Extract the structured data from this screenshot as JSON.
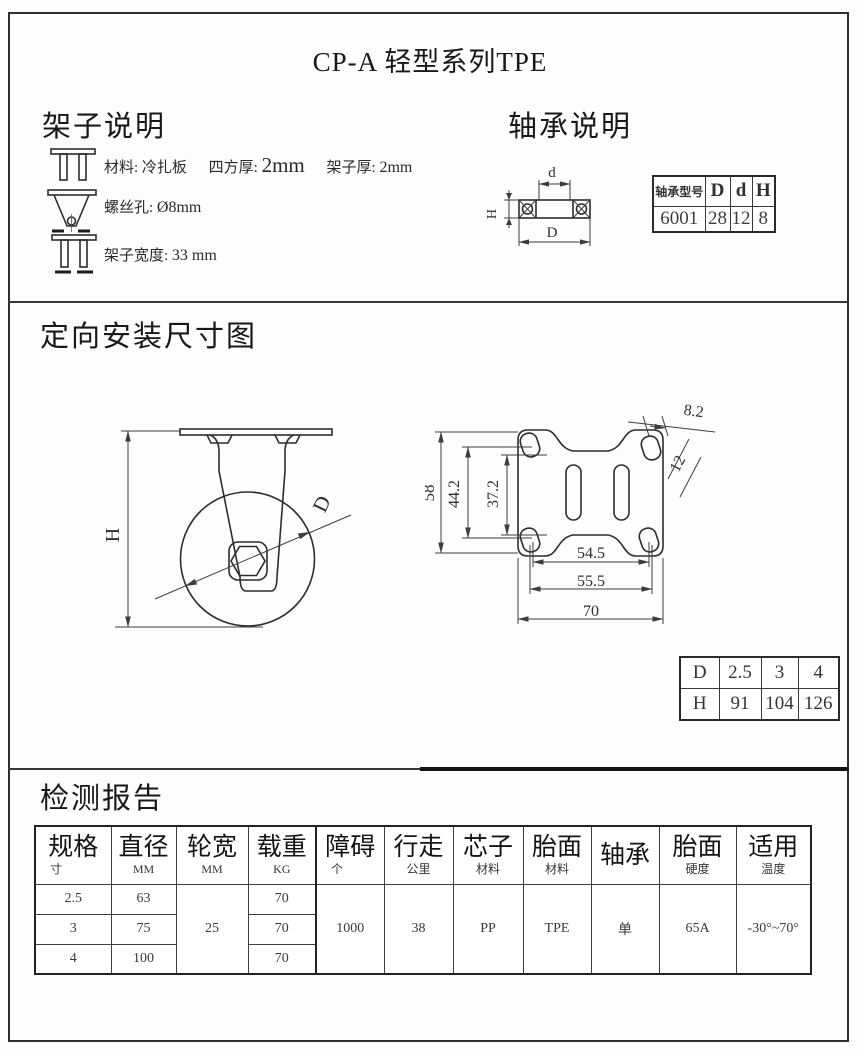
{
  "page_title": "CP-A  轻型系列TPE",
  "frame_section": {
    "heading": "架子说明",
    "material_line": {
      "label1": "材料: 冷扎板",
      "label2": "四方厚:",
      "value2": "2mm",
      "label3": "架子厚:",
      "value3": "2mm"
    },
    "screw_line": {
      "label": "螺丝孔:",
      "value": "Ø8mm"
    },
    "width_line": {
      "label": "架子宽度:",
      "value": "33 mm"
    }
  },
  "bearing_section": {
    "heading": "轴承说明",
    "diagram": {
      "dim_d": "d",
      "dim_D": "D",
      "dim_H": "H"
    },
    "table": {
      "col_model": "轴承型号",
      "col_D": "D",
      "col_d": "d",
      "col_H": "H",
      "model": "6001",
      "D": "28",
      "d": "12",
      "H": "8"
    }
  },
  "mounting_section": {
    "heading": "定向安装尺寸图",
    "side_view": {
      "dim_H": "H",
      "dim_D": "D"
    },
    "top_view": {
      "plate_height": "58",
      "hole_span_v": "44.2",
      "slot_span_v": "37.2",
      "hole_span_h": "54.5",
      "hole_span_h2": "55.5",
      "plate_width": "70",
      "hole_width": "8.2",
      "hole_length": "12"
    },
    "dh_table": {
      "row_d": [
        "D",
        "2.5",
        "3",
        "4"
      ],
      "row_h": [
        "H",
        "91",
        "104",
        "126"
      ]
    }
  },
  "report_section": {
    "heading": "检测报告",
    "table": {
      "headers": [
        {
          "main": "规格",
          "sub": "寸"
        },
        {
          "main": "直径",
          "sub": "MM"
        },
        {
          "main": "轮宽",
          "sub": "MM"
        },
        {
          "main": "载重",
          "sub": "KG"
        },
        {
          "main": "障碍",
          "sub": "个"
        },
        {
          "main": "行走",
          "sub": "公里"
        },
        {
          "main": "芯子",
          "sub": "材料"
        },
        {
          "main": "胎面",
          "sub": "材料"
        },
        {
          "main": "轴承",
          "sub": ""
        },
        {
          "main": "胎面",
          "sub": "硬度"
        },
        {
          "main": "适用",
          "sub": "温度"
        }
      ],
      "rows": [
        {
          "spec": "2.5",
          "diameter": "63",
          "load": "70"
        },
        {
          "spec": "3",
          "diameter": "75",
          "load": "70"
        },
        {
          "spec": "4",
          "diameter": "100",
          "load": "70"
        }
      ],
      "merged": {
        "wheel_width": "25",
        "obstacles": "1000",
        "travel": "38",
        "core_material": "PP",
        "tread_material": "TPE",
        "bearing": "单",
        "tread_hardness": "65A",
        "temp_range": "-30°~70°"
      }
    }
  }
}
